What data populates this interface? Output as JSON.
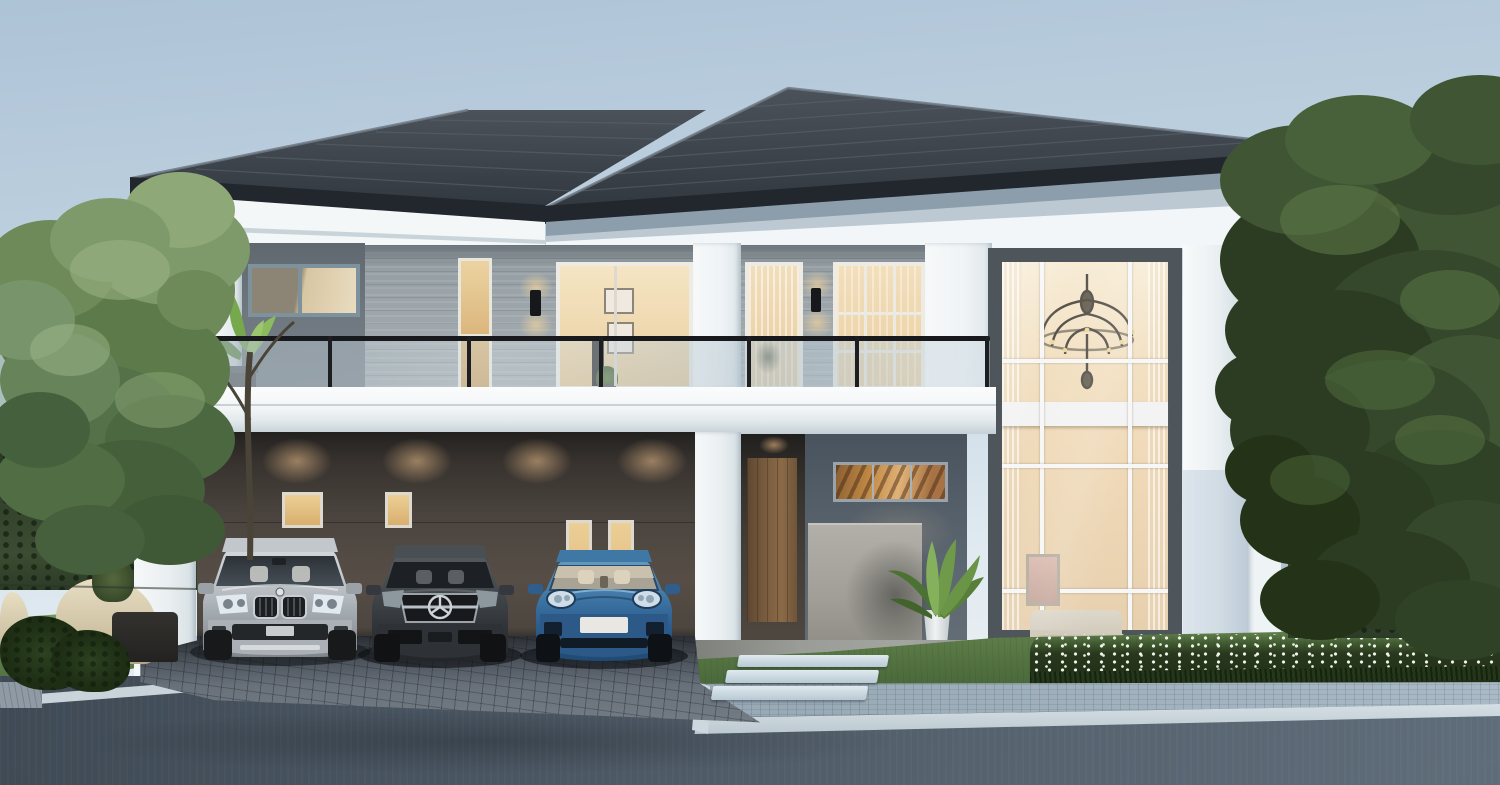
{
  "scene": {
    "type": "architectural-render-photo",
    "description": "Photorealistic dusk rendering of a modern two-storey luxury house with a three-car carport, glass balcony, double-height feature window with chandelier, landscaped garden, paver driveway and asphalt road in the foreground",
    "time_of_day": "dusk",
    "house": {
      "storeys": 2,
      "style": "modern contemporary",
      "roof": "dark charcoal hipped tile roof with layered white and blue-grey cornices",
      "features": [
        "glass balustrade balcony across the upper floor",
        "warm-lit sliding doors and french doors on the upper floor",
        "black up/down wall sconces",
        "double-height grid window with classic chandelier and living room visible",
        "recessed entry porch with wooden door and warm transom window",
        "white columns and pilasters",
        "grey stone-tile and dark grey feature walls",
        "carport with downlights for three cars"
      ]
    },
    "vehicles": [
      {
        "kind": "compact SUV",
        "styling": "BMW-X1-like",
        "color_name": "silver"
      },
      {
        "kind": "coupe sedan",
        "styling": "Mercedes-CLA-like",
        "color_name": "dark grey"
      },
      {
        "kind": "sports sedan",
        "styling": "Porsche-Panamera-like",
        "color_name": "metallic blue"
      }
    ],
    "landscaping": [
      "light green tree and clipped hedge on the left",
      "cream curved outdoor armchairs with dark side table",
      "dense dark tree, hedge and neighbouring roof on the right",
      "white flower bed beside the lawn",
      "potted palm plant at the entrance",
      "light stepping stones across the lawn",
      "herringbone paver driveway, light paver sidewalk, white curb, asphalt road"
    ],
    "interior_glimpses": [
      "framed pictures and TV behind upper sliding door",
      "chandelier and sofa behind double-height window",
      "staircase glow behind entry transom window"
    ]
  },
  "palette": {
    "sky_top": "#adc3d6",
    "sky_mid": "#c2d4e2",
    "sky_low": "#dfe9f0",
    "sky_horizon": "#edf2f5",
    "roof_dark": "#32383f",
    "roof_light": "#4b525a",
    "fascia": "#22272d",
    "cornice_1": "#8c9eab",
    "cornice_2": "#bcc9d2",
    "white_band": "#f3f6f8",
    "wall_dark": "#6e777e",
    "wall_stone": "#9ba4a9",
    "entry_wall": "#545e68",
    "warm_hi": "#f6ead2",
    "warm_lo": "#e2c08a",
    "lawn_1": "#61814b",
    "lawn_2": "#42603a",
    "hedge_1": "#31422a",
    "hedge_2": "#24351d",
    "paver": "#5f6771",
    "road_1": "#434e59",
    "road_2": "#5f6d7a",
    "sidewalk": "#a3b4c0",
    "curb": "#d3dde2",
    "car_silver": "#b6bcc1",
    "car_grey": "#42474c",
    "car_blue": "#336899"
  }
}
